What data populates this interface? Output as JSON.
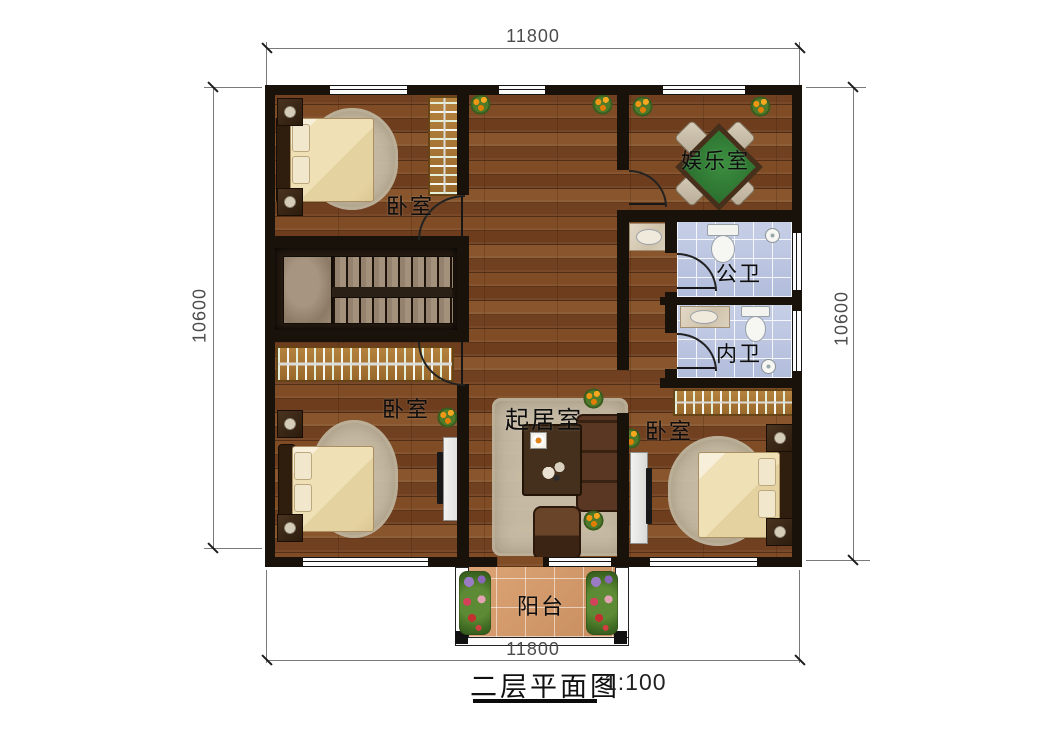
{
  "title": {
    "text": "二层平面图",
    "scale": "1:100"
  },
  "dimensions": {
    "top": "11800",
    "bottom": "11800",
    "left": "10600",
    "right": "10600"
  },
  "rooms": {
    "bedroom_tl": {
      "label": "卧室"
    },
    "entertainment": {
      "label": "娱乐室"
    },
    "public_bath": {
      "label": "公卫"
    },
    "private_bath": {
      "label": "内卫"
    },
    "bedroom_bl": {
      "label": "卧室"
    },
    "living": {
      "label": "起居室"
    },
    "bedroom_br": {
      "label": "卧室"
    },
    "balcony": {
      "label": "阳台"
    }
  },
  "theme": {
    "wall": "#19120b",
    "floor_wood": "#7a4823",
    "bath_tile": "#c2cbe2",
    "balcony_tile": "#d49a6b",
    "rug": "#cbc2ad",
    "bed_duvet": "#efe0b6",
    "sofa_brown": "#4e2f1c",
    "mahjong_green": "#2e7b33",
    "dim_line_color": "#7a7a7a",
    "dim_text_color": "#4c4c4c",
    "label_color": "#0d0d0d"
  }
}
